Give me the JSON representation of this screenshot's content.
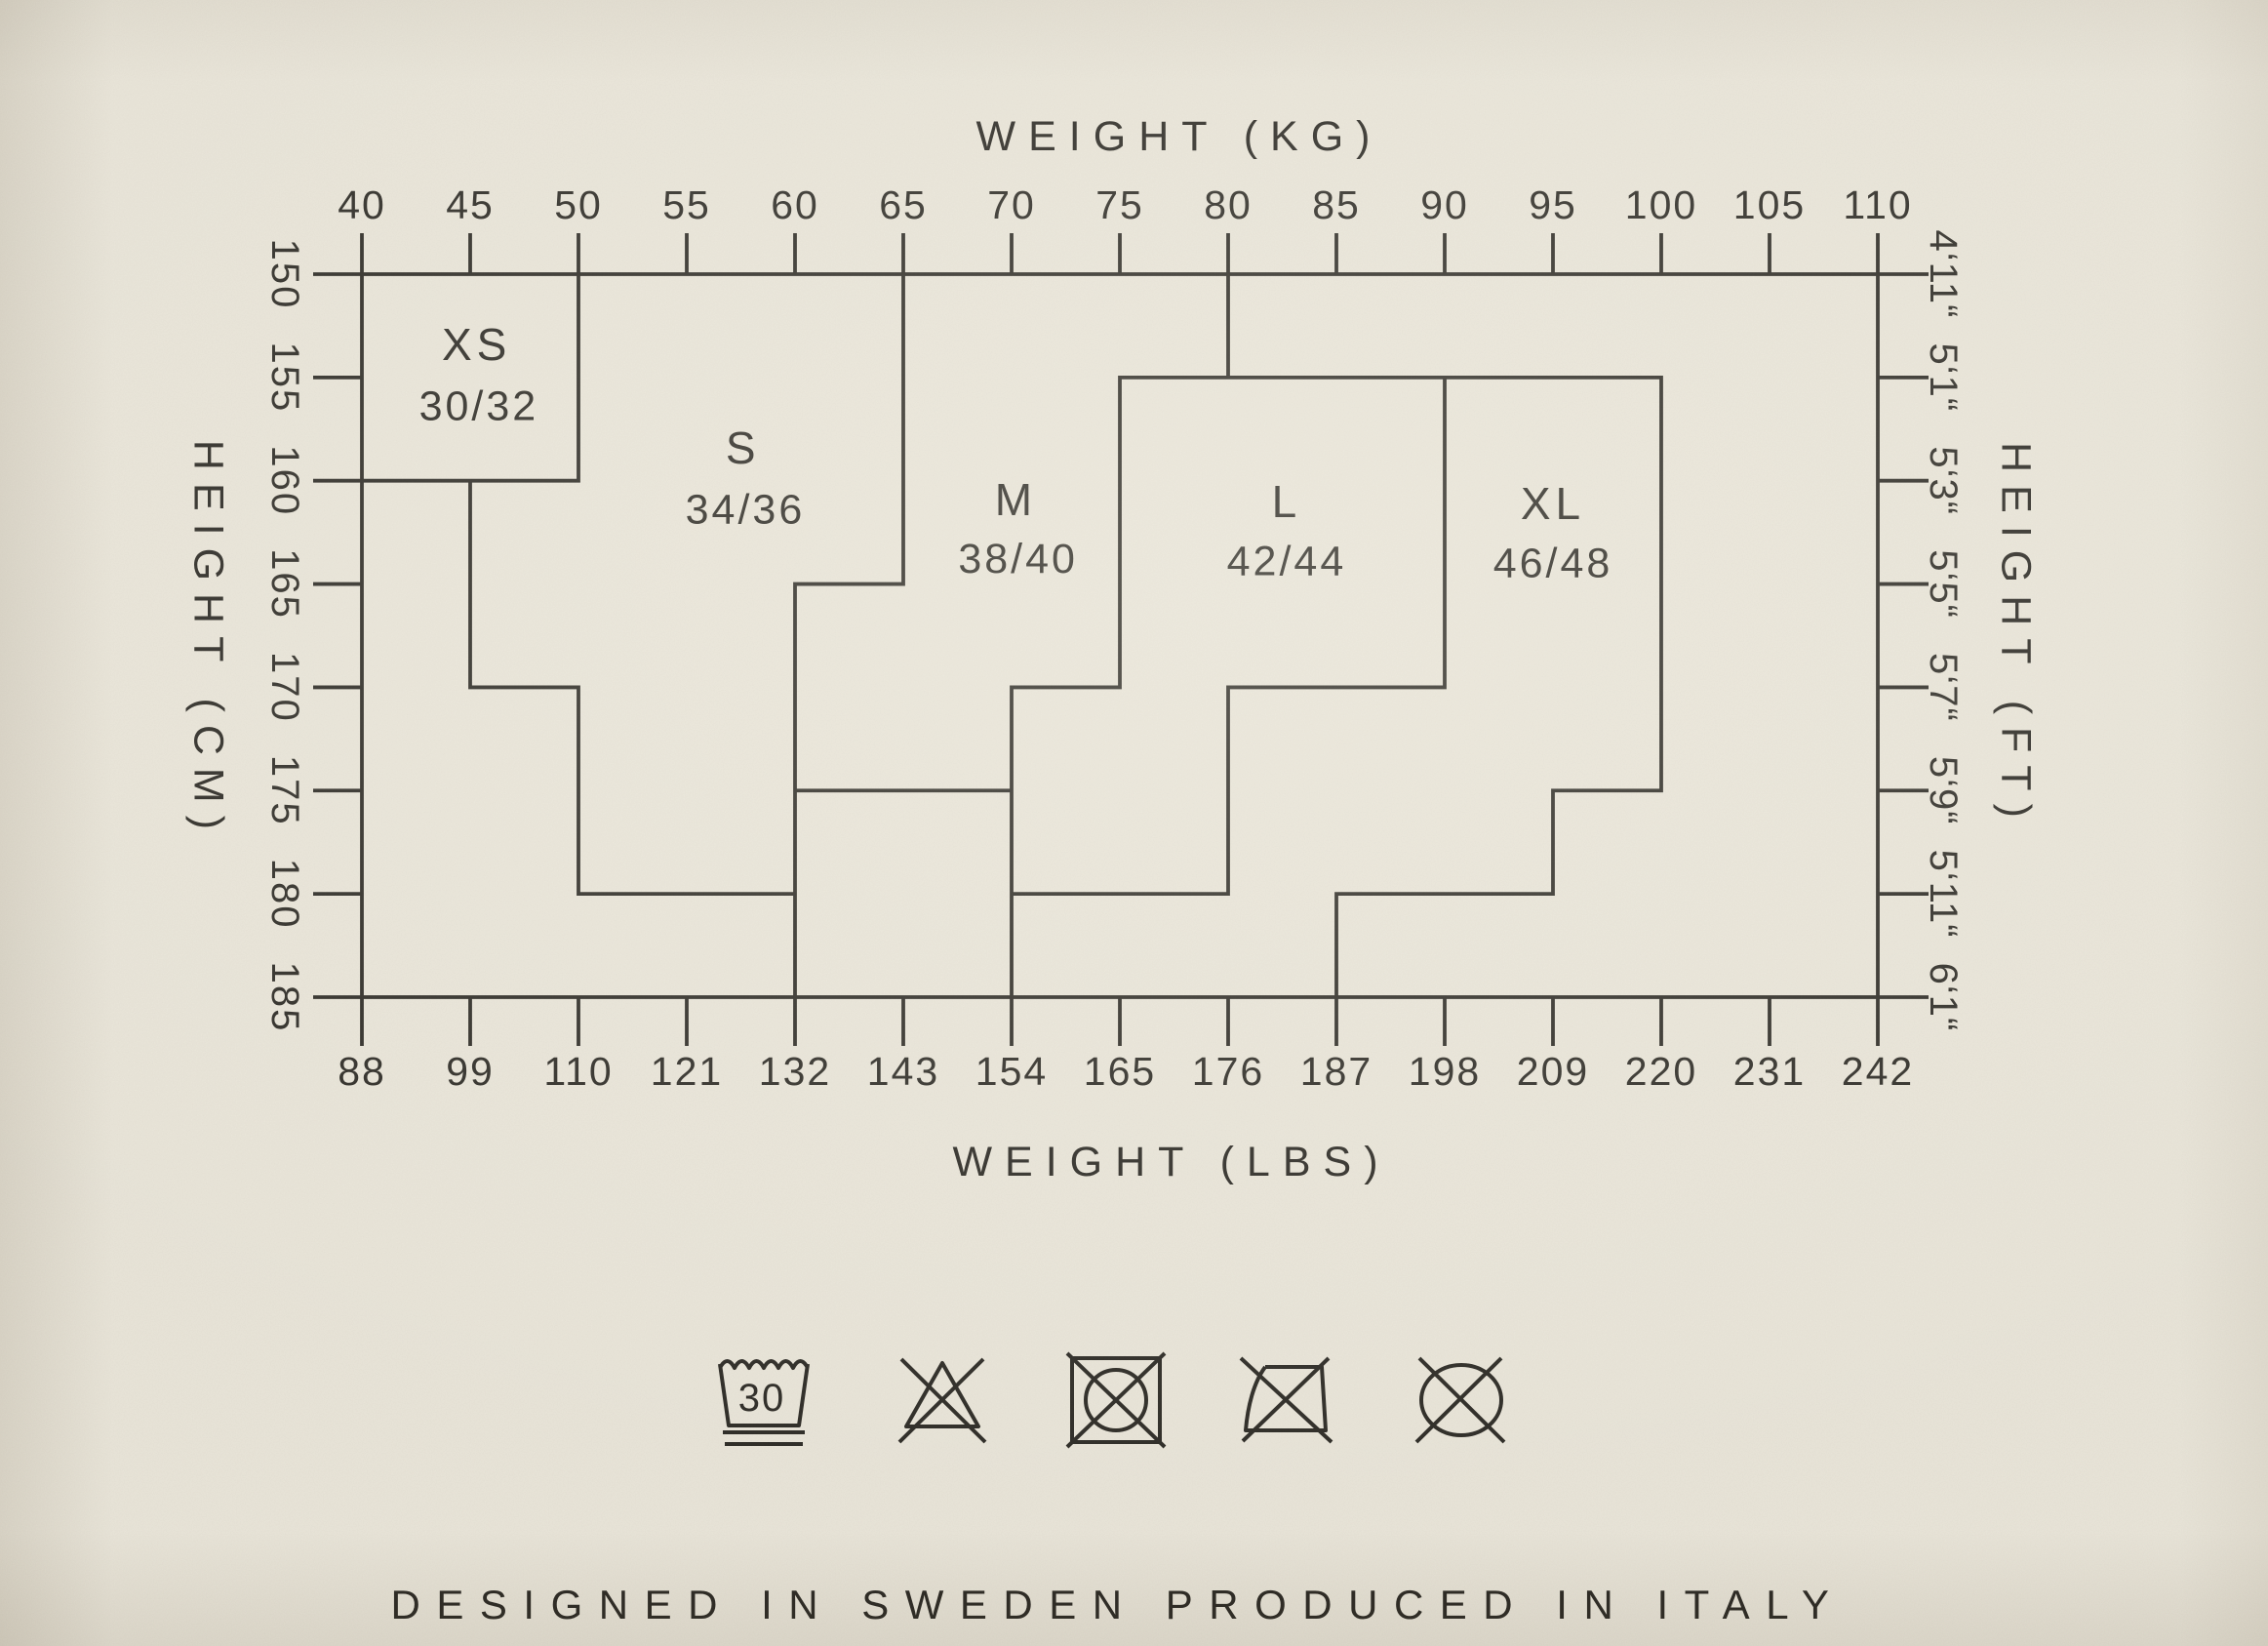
{
  "page": {
    "background": "#e9e5d9",
    "ink": "#2d2b26"
  },
  "footer": "DESIGNED IN SWEDEN PRODUCED IN ITALY",
  "chart_data": {
    "type": "size-region-step-chart",
    "title": "",
    "description": "Clothing size chart: body weight (kg top axis, lbs bottom axis) vs body height (cm left axis, ft-in right axis). Stepped boundary lines divide the grid into garment size regions XS to XL with EU sizes 30/32 to 46/48.",
    "grid": false,
    "legend": false,
    "x_axis_top": {
      "label": "WEIGHT (KG)",
      "unit": "kg",
      "min": 40,
      "max": 110,
      "step": 5,
      "ticks": [
        40,
        45,
        50,
        55,
        60,
        65,
        70,
        75,
        80,
        85,
        90,
        95,
        100,
        105,
        110
      ]
    },
    "x_axis_bottom": {
      "label": "WEIGHT (LBS)",
      "unit": "lbs",
      "ticks": [
        88,
        99,
        110,
        121,
        132,
        143,
        154,
        165,
        176,
        187,
        198,
        209,
        220,
        231,
        242
      ]
    },
    "y_axis_left": {
      "label": "HEIGHT (CM)",
      "unit": "cm",
      "min": 150,
      "max": 185,
      "step": 5,
      "ticks": [
        150,
        155,
        160,
        165,
        170,
        175,
        180,
        185
      ]
    },
    "y_axis_right": {
      "label": "HEIGHT (FT)",
      "unit": "ft-in",
      "ticks": [
        "4‘11“",
        "5‘1“",
        "5‘3“",
        "5‘5“",
        "5‘7“",
        "5‘9“",
        "5‘11“",
        "6‘1“"
      ]
    },
    "regions": [
      {
        "size": "XS",
        "eu_size": "30/32",
        "label_kg": 45.3,
        "label_cm": 153.4,
        "eu_kg": 45.4,
        "eu_cm": 156.4
      },
      {
        "size": "S",
        "eu_size": "34/36",
        "label_kg": 57.6,
        "label_cm": 158.4,
        "eu_kg": 57.7,
        "eu_cm": 161.4
      },
      {
        "size": "M",
        "eu_size": "38/40",
        "label_kg": 70.2,
        "label_cm": 160.9,
        "eu_kg": 70.3,
        "eu_cm": 163.8
      },
      {
        "size": "L",
        "eu_size": "42/44",
        "label_kg": 82.7,
        "label_cm": 161.0,
        "eu_kg": 82.7,
        "eu_cm": 163.9
      },
      {
        "size": "XL",
        "eu_size": "46/48",
        "label_kg": 95.0,
        "label_cm": 161.1,
        "eu_kg": 95.0,
        "eu_cm": 164.0
      }
    ],
    "boundaries": [
      {
        "name": "xs-box-right-and-bottom",
        "points": [
          [
            50,
            150
          ],
          [
            50,
            160
          ],
          [
            40,
            160
          ]
        ]
      },
      {
        "name": "xs-s-lower-staircase",
        "points": [
          [
            45,
            160
          ],
          [
            45,
            170
          ],
          [
            50,
            170
          ],
          [
            50,
            180
          ],
          [
            60,
            180
          ]
        ]
      },
      {
        "name": "s-m-boundary",
        "points": [
          [
            65,
            150
          ],
          [
            65,
            165
          ],
          [
            60,
            165
          ],
          [
            60,
            185
          ]
        ]
      },
      {
        "name": "m-bottom-branch",
        "points": [
          [
            60,
            175
          ],
          [
            70,
            175
          ]
        ]
      },
      {
        "name": "m-l-top-stub",
        "points": [
          [
            80,
            150
          ],
          [
            80,
            155
          ]
        ]
      },
      {
        "name": "m-l-xl-outline",
        "points": [
          [
            70,
            185
          ],
          [
            70,
            170
          ],
          [
            75,
            170
          ],
          [
            75,
            155
          ],
          [
            100,
            155
          ],
          [
            100,
            175
          ],
          [
            95,
            175
          ],
          [
            95,
            180
          ],
          [
            85,
            180
          ],
          [
            85,
            185
          ]
        ]
      },
      {
        "name": "l-xl-lower-staircase",
        "points": [
          [
            90,
            155
          ],
          [
            90,
            170
          ],
          [
            80,
            170
          ],
          [
            80,
            180
          ],
          [
            70,
            180
          ]
        ]
      }
    ]
  },
  "care_symbols": [
    {
      "name": "machine-wash-30-very-gentle-icon",
      "temp": "30"
    },
    {
      "name": "do-not-bleach-icon"
    },
    {
      "name": "do-not-tumble-dry-icon"
    },
    {
      "name": "do-not-iron-icon"
    },
    {
      "name": "do-not-dry-clean-icon"
    }
  ]
}
